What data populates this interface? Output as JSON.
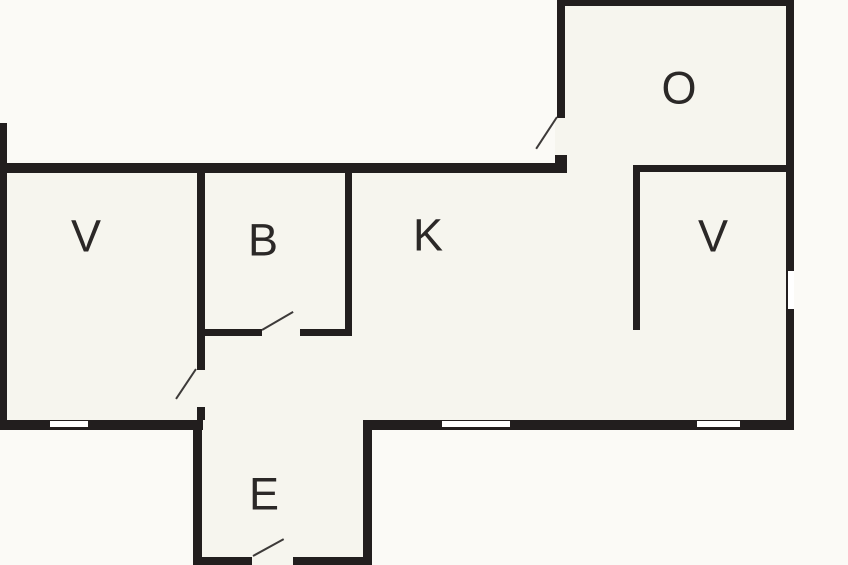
{
  "plan": {
    "title": "floor-plan",
    "canvas": {
      "width": 848,
      "height": 565
    },
    "colors": {
      "exterior": "#fbfaf6",
      "interior": "#f6f5ee",
      "wall": "#221e1e",
      "label": "#2b2827",
      "door_line": "#3d3a39",
      "window": "#ffffff"
    },
    "regions": [
      {
        "name": "main-band",
        "x": 0,
        "y": 163,
        "w": 794,
        "h": 267
      },
      {
        "name": "o-extension",
        "x": 557,
        "y": 0,
        "w": 237,
        "h": 173
      },
      {
        "name": "e-extension",
        "x": 193,
        "y": 420,
        "w": 179,
        "h": 145
      }
    ],
    "walls": [
      {
        "name": "left-wall",
        "x": 0,
        "y": 123,
        "w": 7,
        "h": 307
      },
      {
        "name": "top-wall-main",
        "x": 0,
        "y": 163,
        "w": 567,
        "h": 10
      },
      {
        "name": "o-top-wall",
        "x": 557,
        "y": 0,
        "w": 237,
        "h": 6
      },
      {
        "name": "o-left-wall-upper",
        "x": 557,
        "y": 0,
        "w": 8,
        "h": 118
      },
      {
        "name": "o-left-wall-stub",
        "x": 555,
        "y": 155,
        "w": 12,
        "h": 18
      },
      {
        "name": "right-wall",
        "x": 786,
        "y": 0,
        "w": 8,
        "h": 430
      },
      {
        "name": "v2-top-wall",
        "x": 633,
        "y": 165,
        "w": 153,
        "h": 7
      },
      {
        "name": "v2-left-wall",
        "x": 633,
        "y": 165,
        "w": 7,
        "h": 165
      },
      {
        "name": "b-left-wall",
        "x": 197,
        "y": 173,
        "w": 8,
        "h": 197
      },
      {
        "name": "b-left-wall-stub",
        "x": 197,
        "y": 407,
        "w": 8,
        "h": 13
      },
      {
        "name": "b-right-wall",
        "x": 345,
        "y": 173,
        "w": 7,
        "h": 163
      },
      {
        "name": "b-bottom-wall-left",
        "x": 197,
        "y": 329,
        "w": 65,
        "h": 7
      },
      {
        "name": "b-bottom-wall-right",
        "x": 300,
        "y": 329,
        "w": 52,
        "h": 7
      },
      {
        "name": "bottom-wall-left",
        "x": 0,
        "y": 420,
        "w": 203,
        "h": 10
      },
      {
        "name": "bottom-wall-right",
        "x": 365,
        "y": 420,
        "w": 429,
        "h": 10
      },
      {
        "name": "e-left-wall",
        "x": 193,
        "y": 420,
        "w": 9,
        "h": 145
      },
      {
        "name": "e-right-wall",
        "x": 363,
        "y": 420,
        "w": 9,
        "h": 145
      },
      {
        "name": "e-bottom-wall-left",
        "x": 193,
        "y": 557,
        "w": 59,
        "h": 8
      },
      {
        "name": "e-bottom-wall-right",
        "x": 293,
        "y": 557,
        "w": 79,
        "h": 8
      }
    ],
    "windows": [
      {
        "name": "window-v1-bottom",
        "x": 50,
        "y": 421,
        "w": 38,
        "h": 6
      },
      {
        "name": "window-k-bottom",
        "x": 442,
        "y": 421,
        "w": 68,
        "h": 6
      },
      {
        "name": "window-v2-bottom",
        "x": 697,
        "y": 421,
        "w": 43,
        "h": 6
      },
      {
        "name": "window-right-wall",
        "x": 788,
        "y": 271,
        "w": 6,
        "h": 38
      }
    ],
    "door_openings": [
      {
        "name": "door-opening-o",
        "x": 555,
        "y": 118,
        "w": 12,
        "h": 37
      },
      {
        "name": "door-opening-b",
        "x": 262,
        "y": 328,
        "w": 38,
        "h": 9
      },
      {
        "name": "door-opening-v1",
        "x": 196,
        "y": 370,
        "w": 11,
        "h": 37
      },
      {
        "name": "door-opening-e",
        "x": 252,
        "y": 556,
        "w": 41,
        "h": 9
      }
    ],
    "door_swings": [
      {
        "name": "door-swing-o",
        "x1": 557,
        "y1": 117,
        "x2": 536,
        "y2": 149
      },
      {
        "name": "door-swing-b",
        "x1": 262,
        "y1": 330,
        "x2": 293,
        "y2": 312
      },
      {
        "name": "door-swing-v1",
        "x1": 196,
        "y1": 369,
        "x2": 176,
        "y2": 399
      },
      {
        "name": "door-swing-e",
        "x1": 253,
        "y1": 556,
        "x2": 284,
        "y2": 539
      }
    ],
    "rooms": [
      {
        "label": "V",
        "x": 86,
        "y": 236
      },
      {
        "label": "B",
        "x": 263,
        "y": 240
      },
      {
        "label": "K",
        "x": 428,
        "y": 235
      },
      {
        "label": "O",
        "x": 679,
        "y": 88
      },
      {
        "label": "V",
        "x": 713,
        "y": 236
      },
      {
        "label": "E",
        "x": 264,
        "y": 494
      }
    ]
  }
}
